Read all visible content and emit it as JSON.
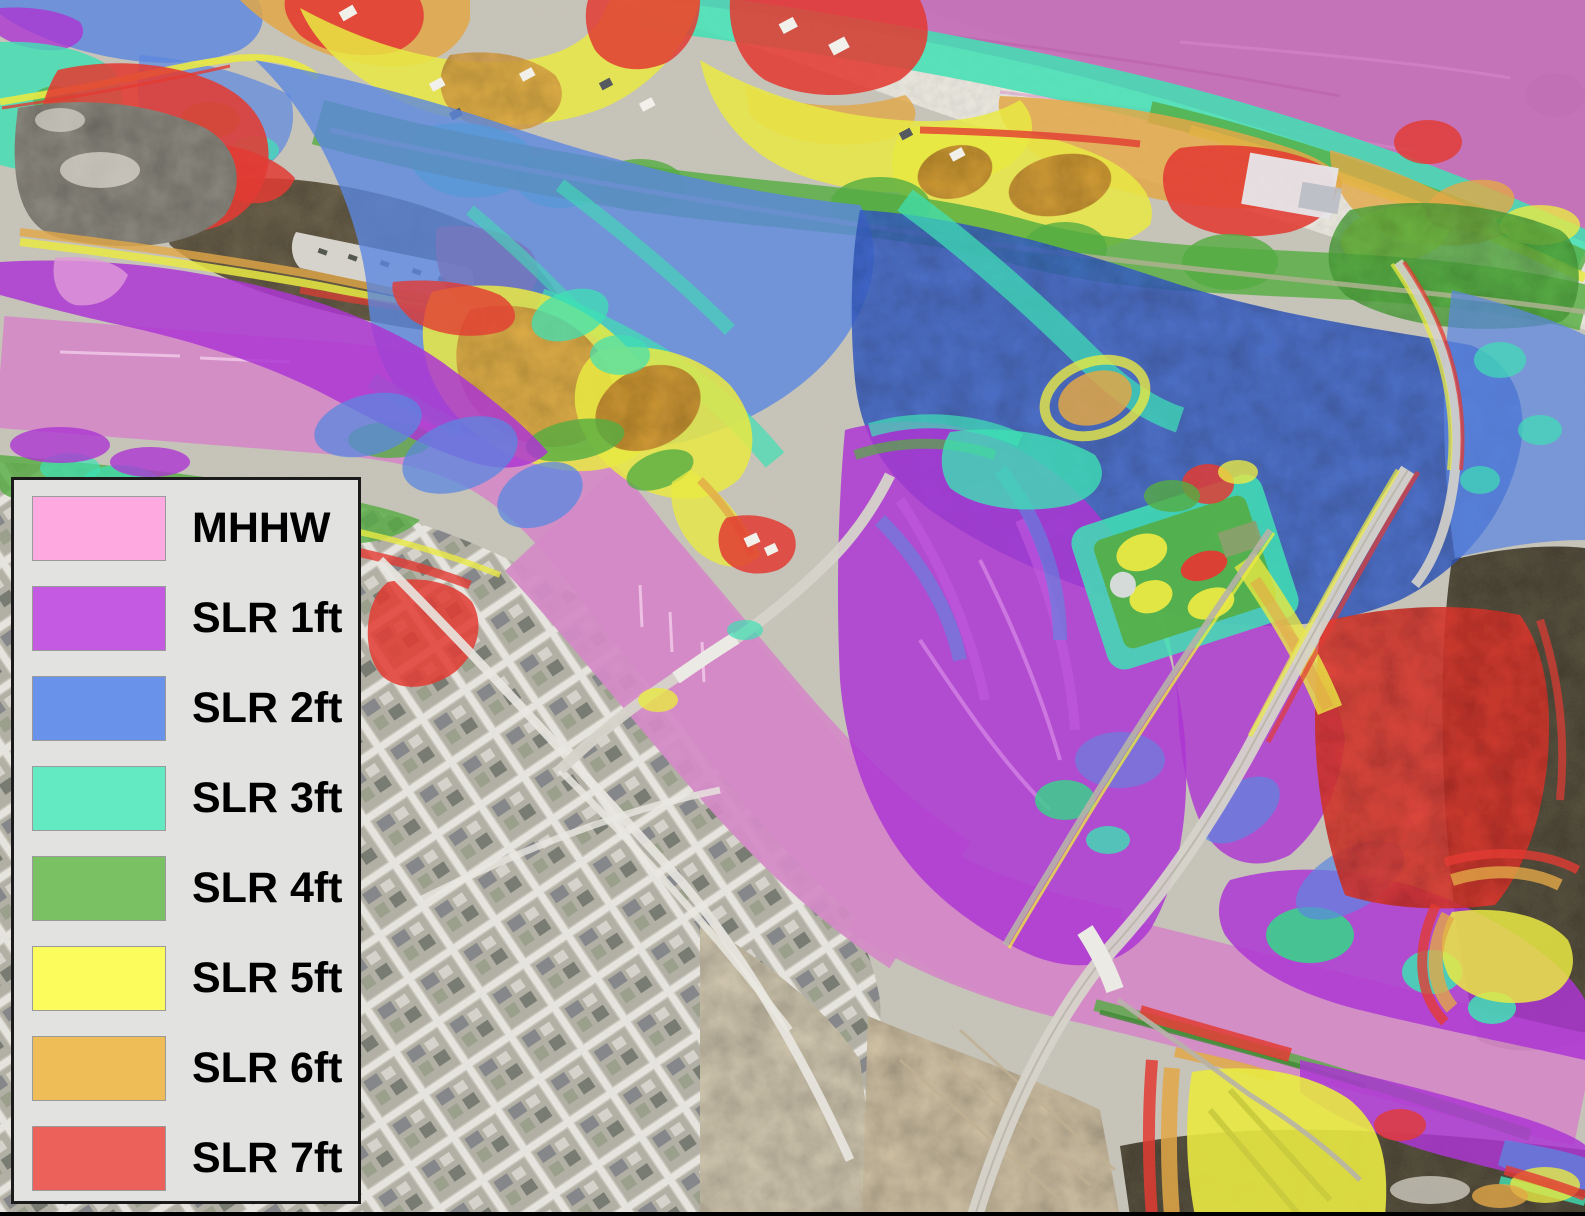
{
  "window": {
    "width_px": 1585,
    "height_px": 1216,
    "kind": "sea-level-rise inundation map over aerial imagery"
  },
  "legend": {
    "panel_bg": "#e2e2e0",
    "panel_border": "#1b1b1b",
    "swatch_border": "#9a9a9a",
    "label_color": "#000000",
    "items": [
      {
        "id": "mhhw",
        "label": "MHHW",
        "color": "#ffa9e1"
      },
      {
        "id": "slr-1ft",
        "label": "SLR 1ft",
        "color": "#c45ae2"
      },
      {
        "id": "slr-2ft",
        "label": "SLR 2ft",
        "color": "#6993ea"
      },
      {
        "id": "slr-3ft",
        "label": "SLR 3ft",
        "color": "#63eac2"
      },
      {
        "id": "slr-4ft",
        "label": "SLR 4ft",
        "color": "#79c163"
      },
      {
        "id": "slr-5ft",
        "label": "SLR 5ft",
        "color": "#fcfc5d"
      },
      {
        "id": "slr-6ft",
        "label": "SLR 6ft",
        "color": "#eebd58"
      },
      {
        "id": "slr-7ft",
        "label": "SLR 7ft",
        "color": "#ec615a"
      }
    ]
  },
  "map": {
    "palette": {
      "ocean": "#c56fb8",
      "river": "#d48ac6",
      "mhhw_marsh": "#e09ad8",
      "pier": "#f2cdeb",
      "slr1": "#ad36d2",
      "slr1_light": "#c25ae0",
      "slr1_creek": "#d98ae8",
      "slr2": "#5b87e0",
      "slr2_deep": "#3a63cf",
      "slr3": "#3fe0b4",
      "slr4": "#55ad42",
      "slr4_bright": "#3bcf8c",
      "slr4_dark": "#3e8a34",
      "slr5": "#e9e943",
      "slr5_dim": "#c9c93e",
      "slr6": "#e2a747",
      "slr6_deep": "#cf9236",
      "slr7": "#e23b33",
      "sand": "#f0ede4",
      "dune_gray": "#b9b4a6",
      "city": "#c8c5bb",
      "street": "#e9e7e1",
      "field": "#d5c6a8",
      "field_light": "#d8cdb4",
      "field_row": "#c2b293",
      "woods": "#6a6148",
      "forest_dark": "#57503d",
      "spoil": "#8f8c82",
      "spoil_light": "#d9d6cd",
      "parking": "#dcdad4",
      "road": "#d6d3ca",
      "rail": "#b7b3a8",
      "bridge": "#eceae4",
      "building_white": "#f2f0ea",
      "roof_dark": "#555a60"
    }
  }
}
